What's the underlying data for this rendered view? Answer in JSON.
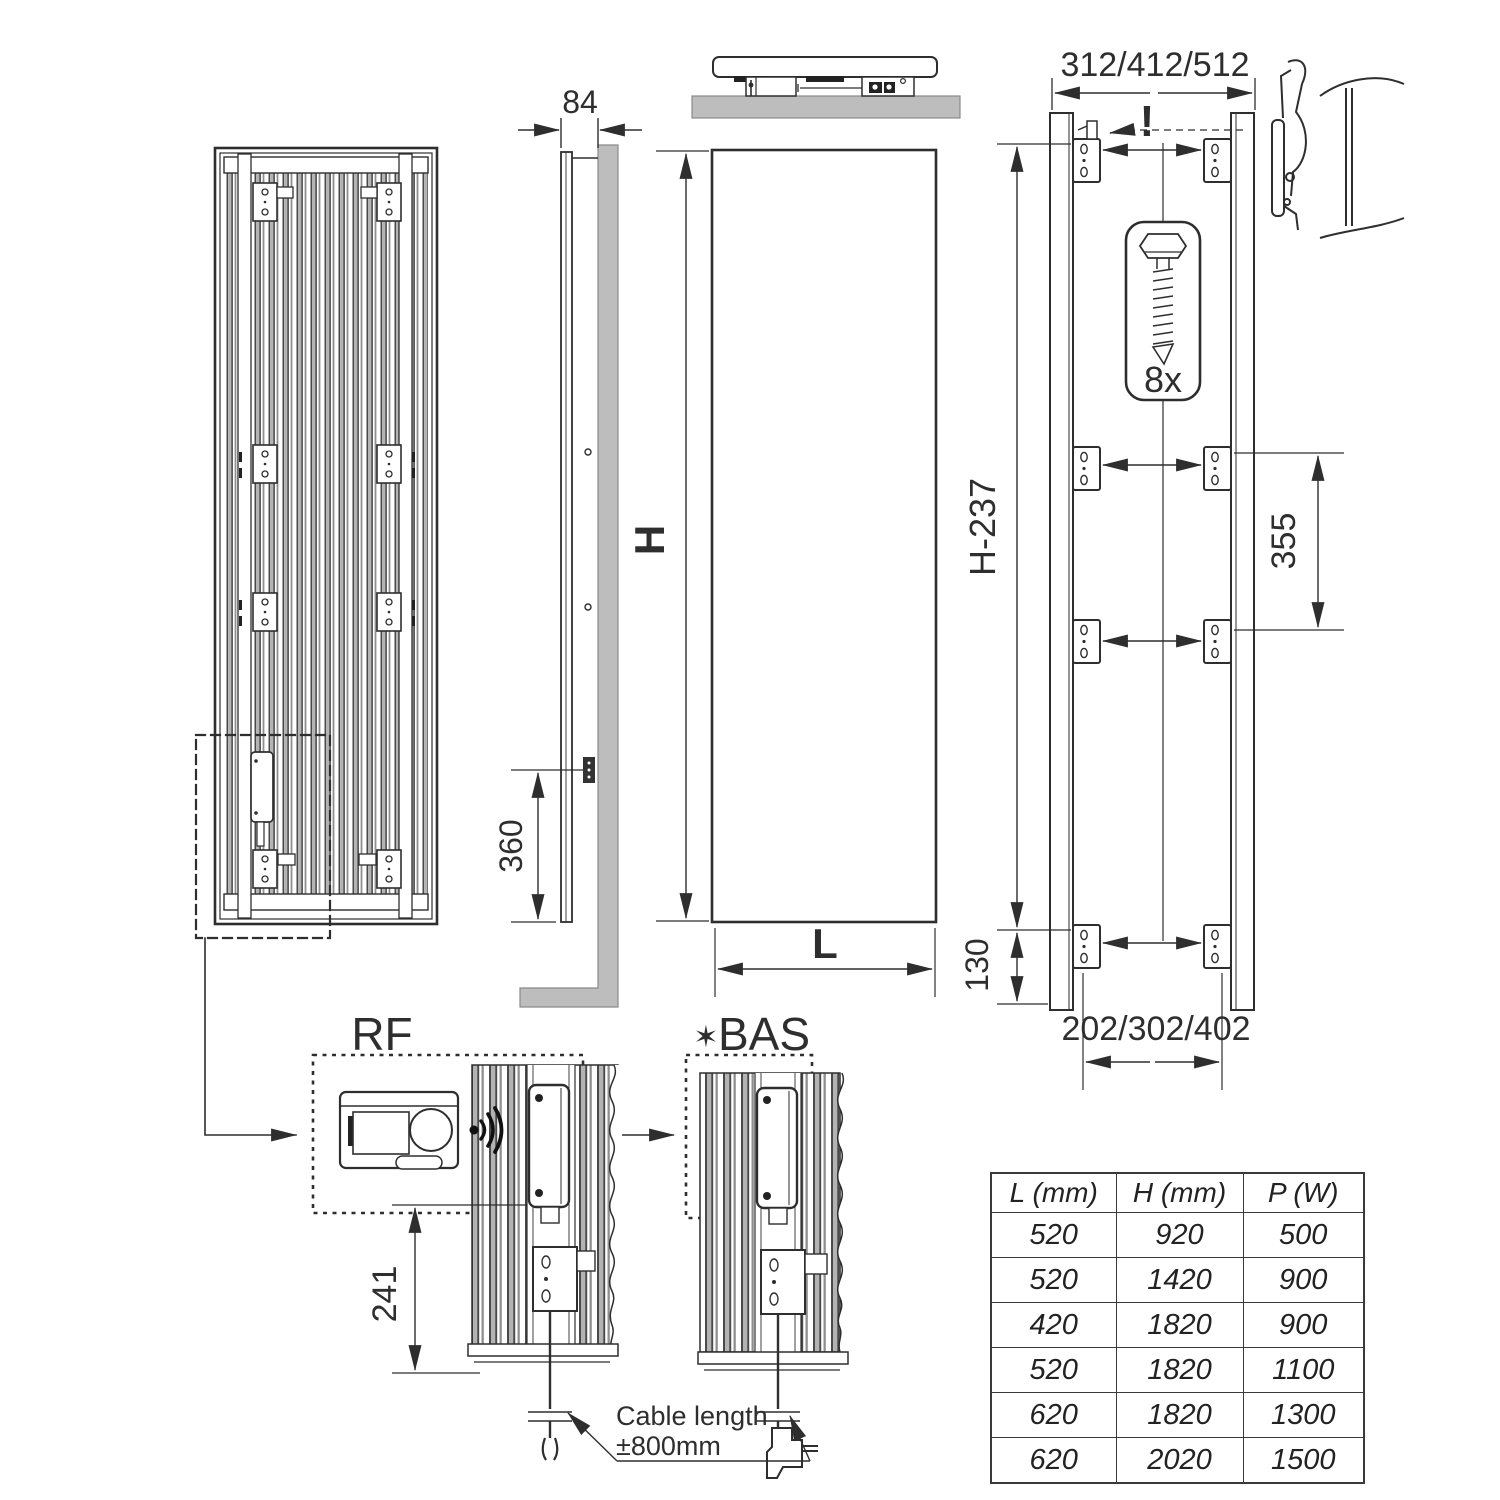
{
  "title": "Vertical radiator installation dimension drawing",
  "palette": {
    "ink": "#2e2e2e",
    "wall_gray": "#bdbdbd",
    "fin_gray": "#b3b3b3"
  },
  "dims": {
    "depth": "84",
    "cable_inlet_height": "360",
    "height_label": "H",
    "length_label": "L",
    "top_bracket_span": "312/412/512",
    "warning_mark": "!",
    "screw_count": "8x",
    "vertical_bracket_span": "H-237",
    "mid_bracket_gap": "355",
    "bottom_bracket_offset": "130",
    "bottom_bracket_span": "202/302/402",
    "control_box_height": "241"
  },
  "details": {
    "rf_label": "RF",
    "bas_star": "✶",
    "bas_label": "BAS",
    "cable_note_line1": "Cable length",
    "cable_note_line2": "±800mm"
  },
  "size_table": {
    "headers": [
      "L (mm)",
      "H (mm)",
      "P (W)"
    ],
    "rows": [
      [
        "520",
        "920",
        "500"
      ],
      [
        "520",
        "1420",
        "900"
      ],
      [
        "420",
        "1820",
        "900"
      ],
      [
        "520",
        "1820",
        "1100"
      ],
      [
        "620",
        "1820",
        "1300"
      ],
      [
        "620",
        "2020",
        "1500"
      ]
    ]
  }
}
